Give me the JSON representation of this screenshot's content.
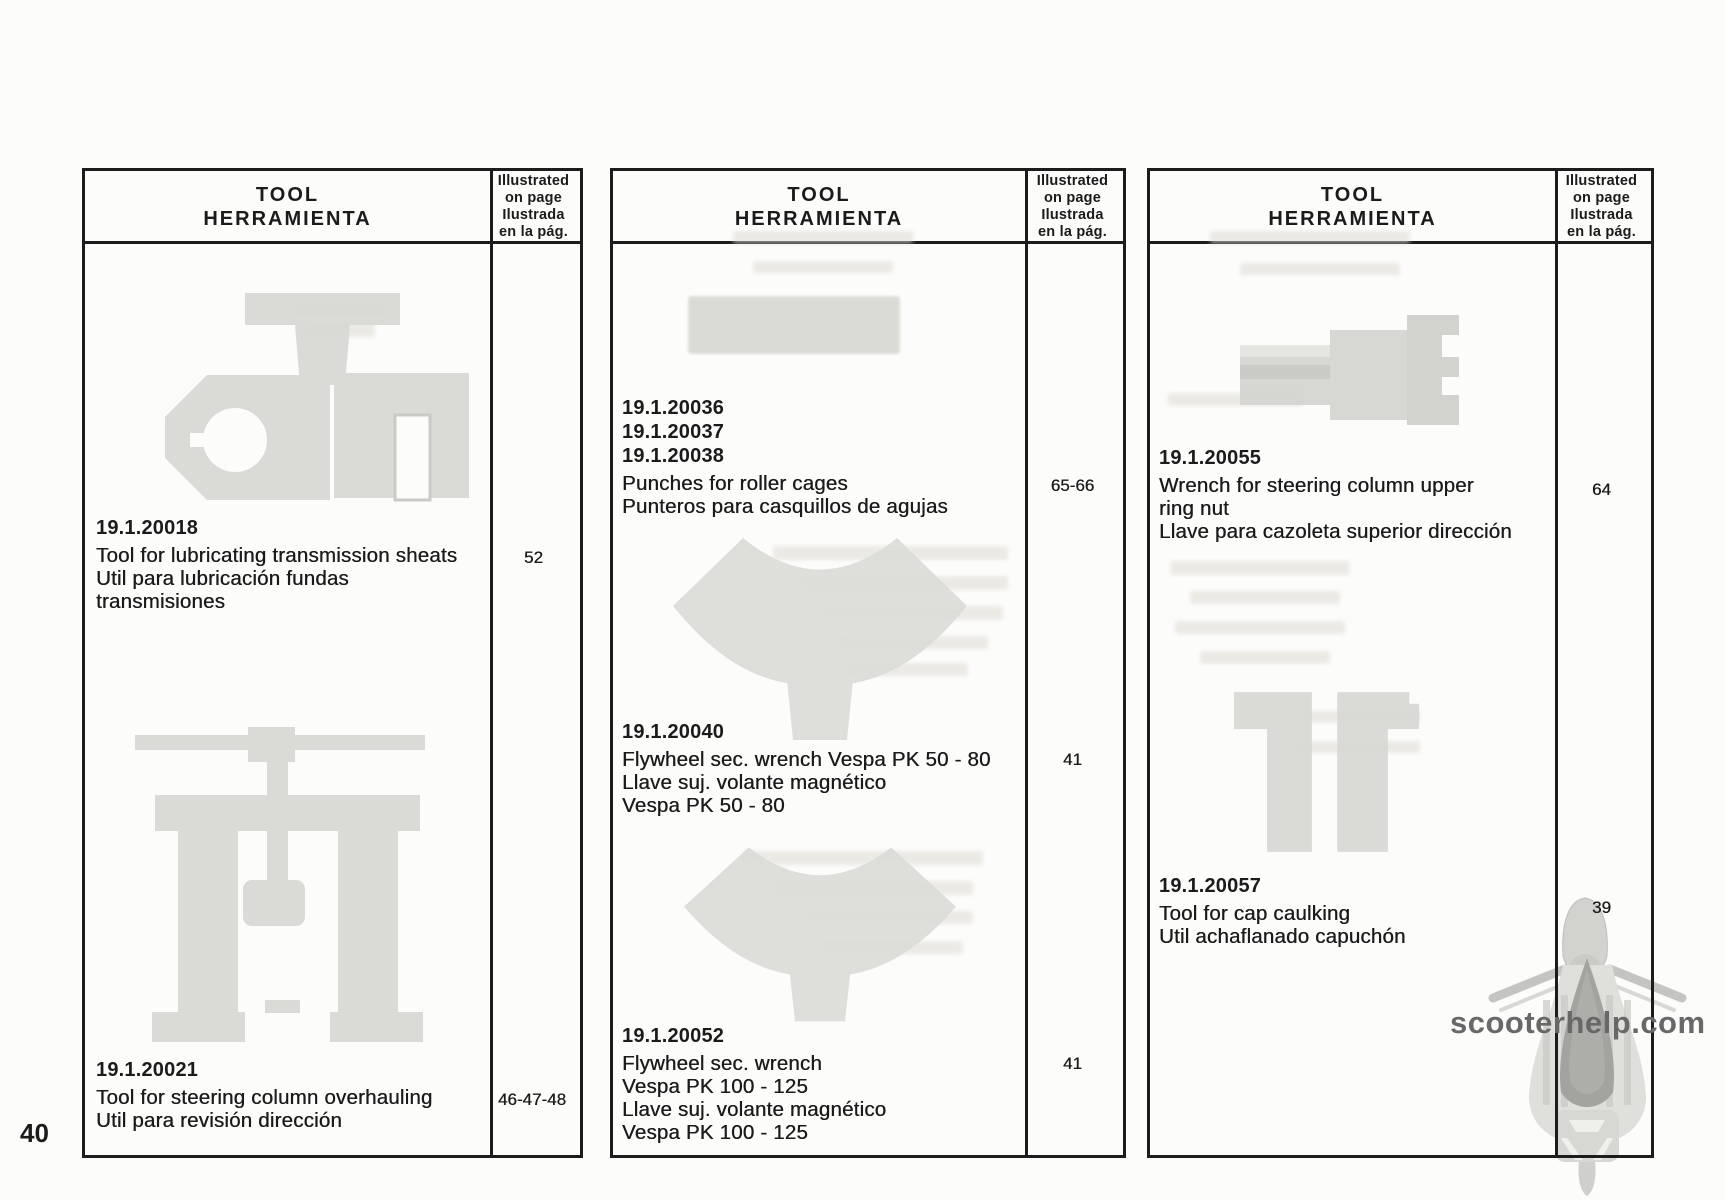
{
  "page_number": "40",
  "watermark_text": "scooterhelp.com",
  "header": {
    "tool_line1": "TOOL",
    "tool_line2": "HERRAMIENTA",
    "ill_line1": "Illustrated",
    "ill_line2": "on page",
    "ill_line3": "Ilustrada",
    "ill_line4": "en la pág."
  },
  "tools": {
    "t20018": {
      "codes": [
        "19.1.20018"
      ],
      "lines": [
        "Tool for lubricating transmission sheats",
        "Util para lubricación fundas",
        "transmisiones"
      ],
      "page": "52"
    },
    "t20021": {
      "codes": [
        "19.1.20021"
      ],
      "lines": [
        "Tool for steering column overhauling",
        "Util para revisión dirección"
      ],
      "page": "46-47-48"
    },
    "t20036": {
      "codes": [
        "19.1.20036",
        "19.1.20037",
        "19.1.20038"
      ],
      "lines": [
        "Punches for roller cages",
        "Punteros para casquillos de agujas"
      ],
      "page": "65-66"
    },
    "t20040": {
      "codes": [
        "19.1.20040"
      ],
      "lines": [
        "Flywheel sec. wrench Vespa PK 50 - 80",
        "Llave suj. volante magnético",
        "Vespa PK 50 - 80"
      ],
      "page": "41"
    },
    "t20052": {
      "codes": [
        "19.1.20052"
      ],
      "lines": [
        "Flywheel sec. wrench",
        "Vespa PK 100 - 125",
        "Llave suj. volante magnético",
        "Vespa PK 100 - 125"
      ],
      "page": "41"
    },
    "t20055": {
      "codes": [
        "19.1.20055"
      ],
      "lines": [
        "Wrench for steering column upper",
        "ring nut",
        "Llave para cazoleta superior dirección"
      ],
      "page": "64"
    },
    "t20057": {
      "codes": [
        "19.1.20057"
      ],
      "lines": [
        "Tool for cap caulking",
        "Util achaflanado capuchón"
      ],
      "page": "39"
    }
  },
  "illustrations": {
    "t20018": "clamp-tool-illustration",
    "t20021": "steering-column-puller-illustration",
    "t20040": "flywheel-wrench-illustration",
    "t20052": "flywheel-wrench-illustration",
    "t20055": "ring-nut-socket-illustration",
    "t20057": "caulking-blocks-illustration"
  },
  "colors": {
    "paper": "#fcfcfb",
    "ink": "#1b1b1b",
    "tool_gray": "#d8d8d4",
    "ghost_gray": "#deded8",
    "watermark_gray": "#686868"
  }
}
